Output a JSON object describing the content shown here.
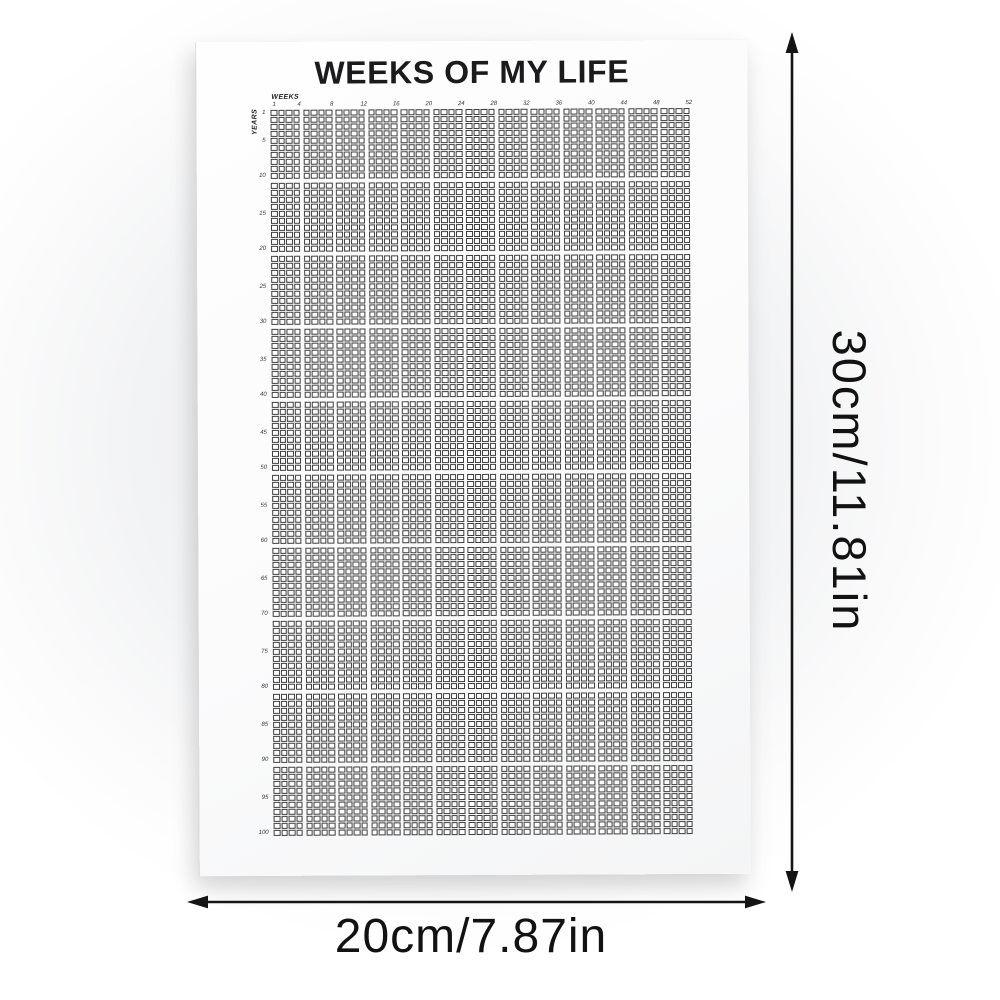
{
  "poster": {
    "title": "WEEKS OF MY LIFE",
    "weeks_axis": {
      "label": "WEEKS",
      "ticks": [
        "1",
        "4",
        "8",
        "12",
        "16",
        "20",
        "24",
        "28",
        "32",
        "36",
        "40",
        "44",
        "48",
        "52"
      ]
    },
    "years_axis": {
      "label": "YEARS",
      "ticks": [
        "1",
        "5",
        "10",
        "15",
        "20",
        "25",
        "30",
        "35",
        "40",
        "45",
        "50",
        "55",
        "60",
        "65",
        "70",
        "75",
        "80",
        "85",
        "90",
        "95",
        "100"
      ]
    },
    "grid": {
      "weeks_per_year": 52,
      "years": 100,
      "column_blocks": 13,
      "columns_per_block": 4,
      "row_blocks": 10,
      "rows_per_block": 10,
      "cell_state": "all-empty"
    }
  },
  "dimension_annotations": {
    "height": "30cm/11.81in",
    "width": "20cm/7.87in"
  },
  "colors": {
    "grid_line": "#3e3e3e",
    "title_text": "#1b1b1d",
    "annotation_text": "#121212",
    "arrow": "#141414",
    "poster_bg": "#fcfcfd",
    "backdrop": "#eff0f1"
  }
}
